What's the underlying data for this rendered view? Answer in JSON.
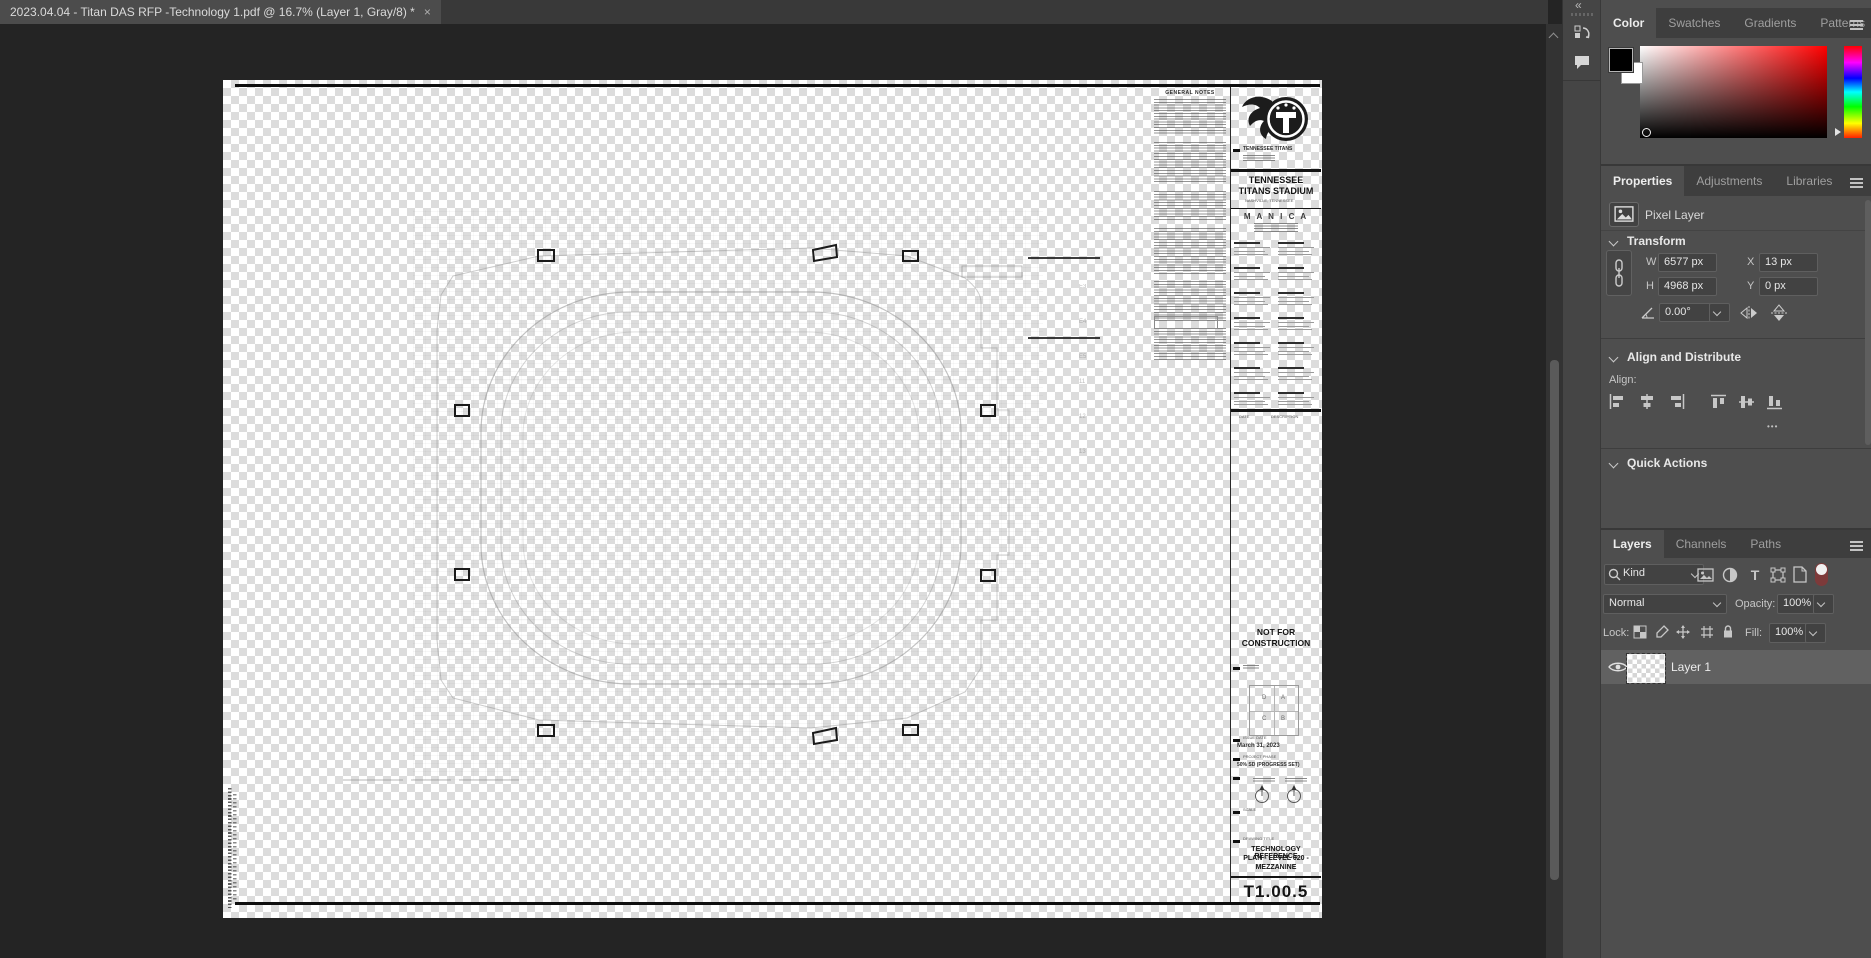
{
  "titlebar": {
    "tab": "2023.04.04 - Titan DAS RFP -Technology 1.pdf @ 16.7% (Layer 1, Gray/8) *",
    "close": "×"
  },
  "strip": {
    "collapse": "«"
  },
  "dock": {
    "collapse": "»"
  },
  "color": {
    "tab_color": "Color",
    "tab_swatches": "Swatches",
    "tab_gradients": "Gradients",
    "tab_patterns": "Patterns"
  },
  "props": {
    "tab_properties": "Properties",
    "tab_adjustments": "Adjustments",
    "tab_libraries": "Libraries",
    "layer_type": "Pixel Layer",
    "transform_title": "Transform",
    "w": "W",
    "w_val": "6577 px",
    "x": "X",
    "x_val": "13 px",
    "h": "H",
    "h_val": "4968 px",
    "y": "Y",
    "y_val": "0 px",
    "angle_val": "0.00°",
    "align_title": "Align and Distribute",
    "align_label": "Align:",
    "more": "•••",
    "quick_title": "Quick Actions"
  },
  "layers": {
    "tab_layers": "Layers",
    "tab_channels": "Channels",
    "tab_paths": "Paths",
    "kind": "Kind",
    "blend": "Normal",
    "opacity_label": "Opacity:",
    "opacity": "100%",
    "lock_label": "Lock:",
    "fill_label": "Fill:",
    "fill": "100%",
    "layer1": "Layer 1"
  },
  "doc": {
    "notes_title": "GENERAL NOTES",
    "team": "TENNESSEE TITANS",
    "stadium1": "TENNESSEE",
    "stadium2": "TITANS STADIUM",
    "stadium_sub": "NASHVILLE, TENNESSEE",
    "architect": "M A N I C A",
    "rev_date": "DATE",
    "rev_desc": "DESCRIPTION",
    "nfc1": "NOT FOR",
    "nfc2": "CONSTRUCTION",
    "kp_d": "D",
    "kp_a": "A",
    "kp_c": "C",
    "kp_b": "B",
    "issue_label": "ISSUE DATE",
    "issue": "March 31, 2023",
    "phase_label": "PROJECT PHASE",
    "phase": "50% SD (PROGRESS SET)",
    "scale_label": "SCALE",
    "title_label": "DRAWING TITLE",
    "dt1": "TECHNOLOGY REFERENCE",
    "dt2": "PLAN - LEVEL 020 -",
    "dt3": "MEZZANINE",
    "sheet": "T1.00.5",
    "grid": [
      "E3",
      "E4",
      "E5",
      "11",
      "12",
      "13"
    ]
  },
  "ui_colors": {
    "panel": "#4e4e4e",
    "panel_tab_row": "#3e3e3e",
    "canvas": "#242424",
    "selected_layer_row": "#616161",
    "field": "#424242"
  }
}
